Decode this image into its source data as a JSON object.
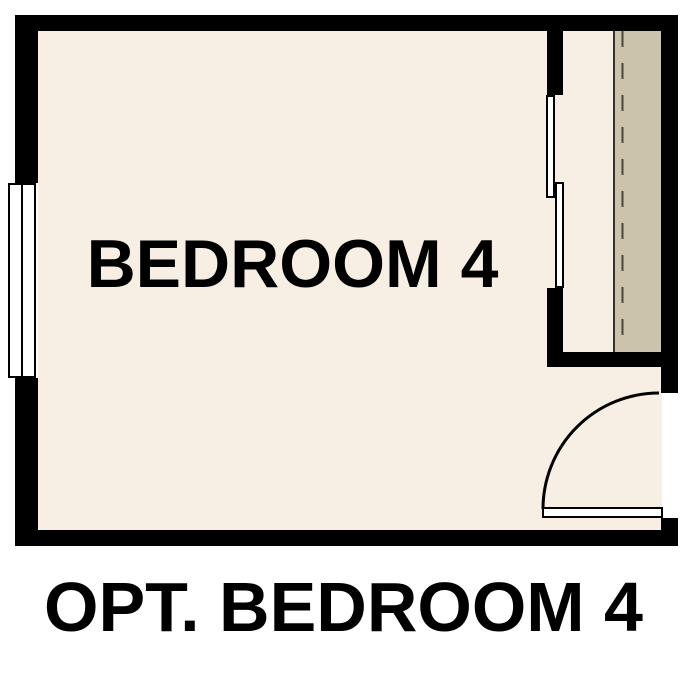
{
  "plan": {
    "room_label": "BEDROOM 4",
    "caption": "OPT. BEDROOM 4"
  },
  "colors": {
    "background": "#FFFFFF",
    "wall": "#000000",
    "floor": "#F7EFE3",
    "closet_shelf": "#CCC3AC",
    "shelf_edge": "#35332C",
    "shelf_rod_dash": "#4A463C",
    "fixture_fill": "#FFFFFF",
    "text": "#000000"
  }
}
